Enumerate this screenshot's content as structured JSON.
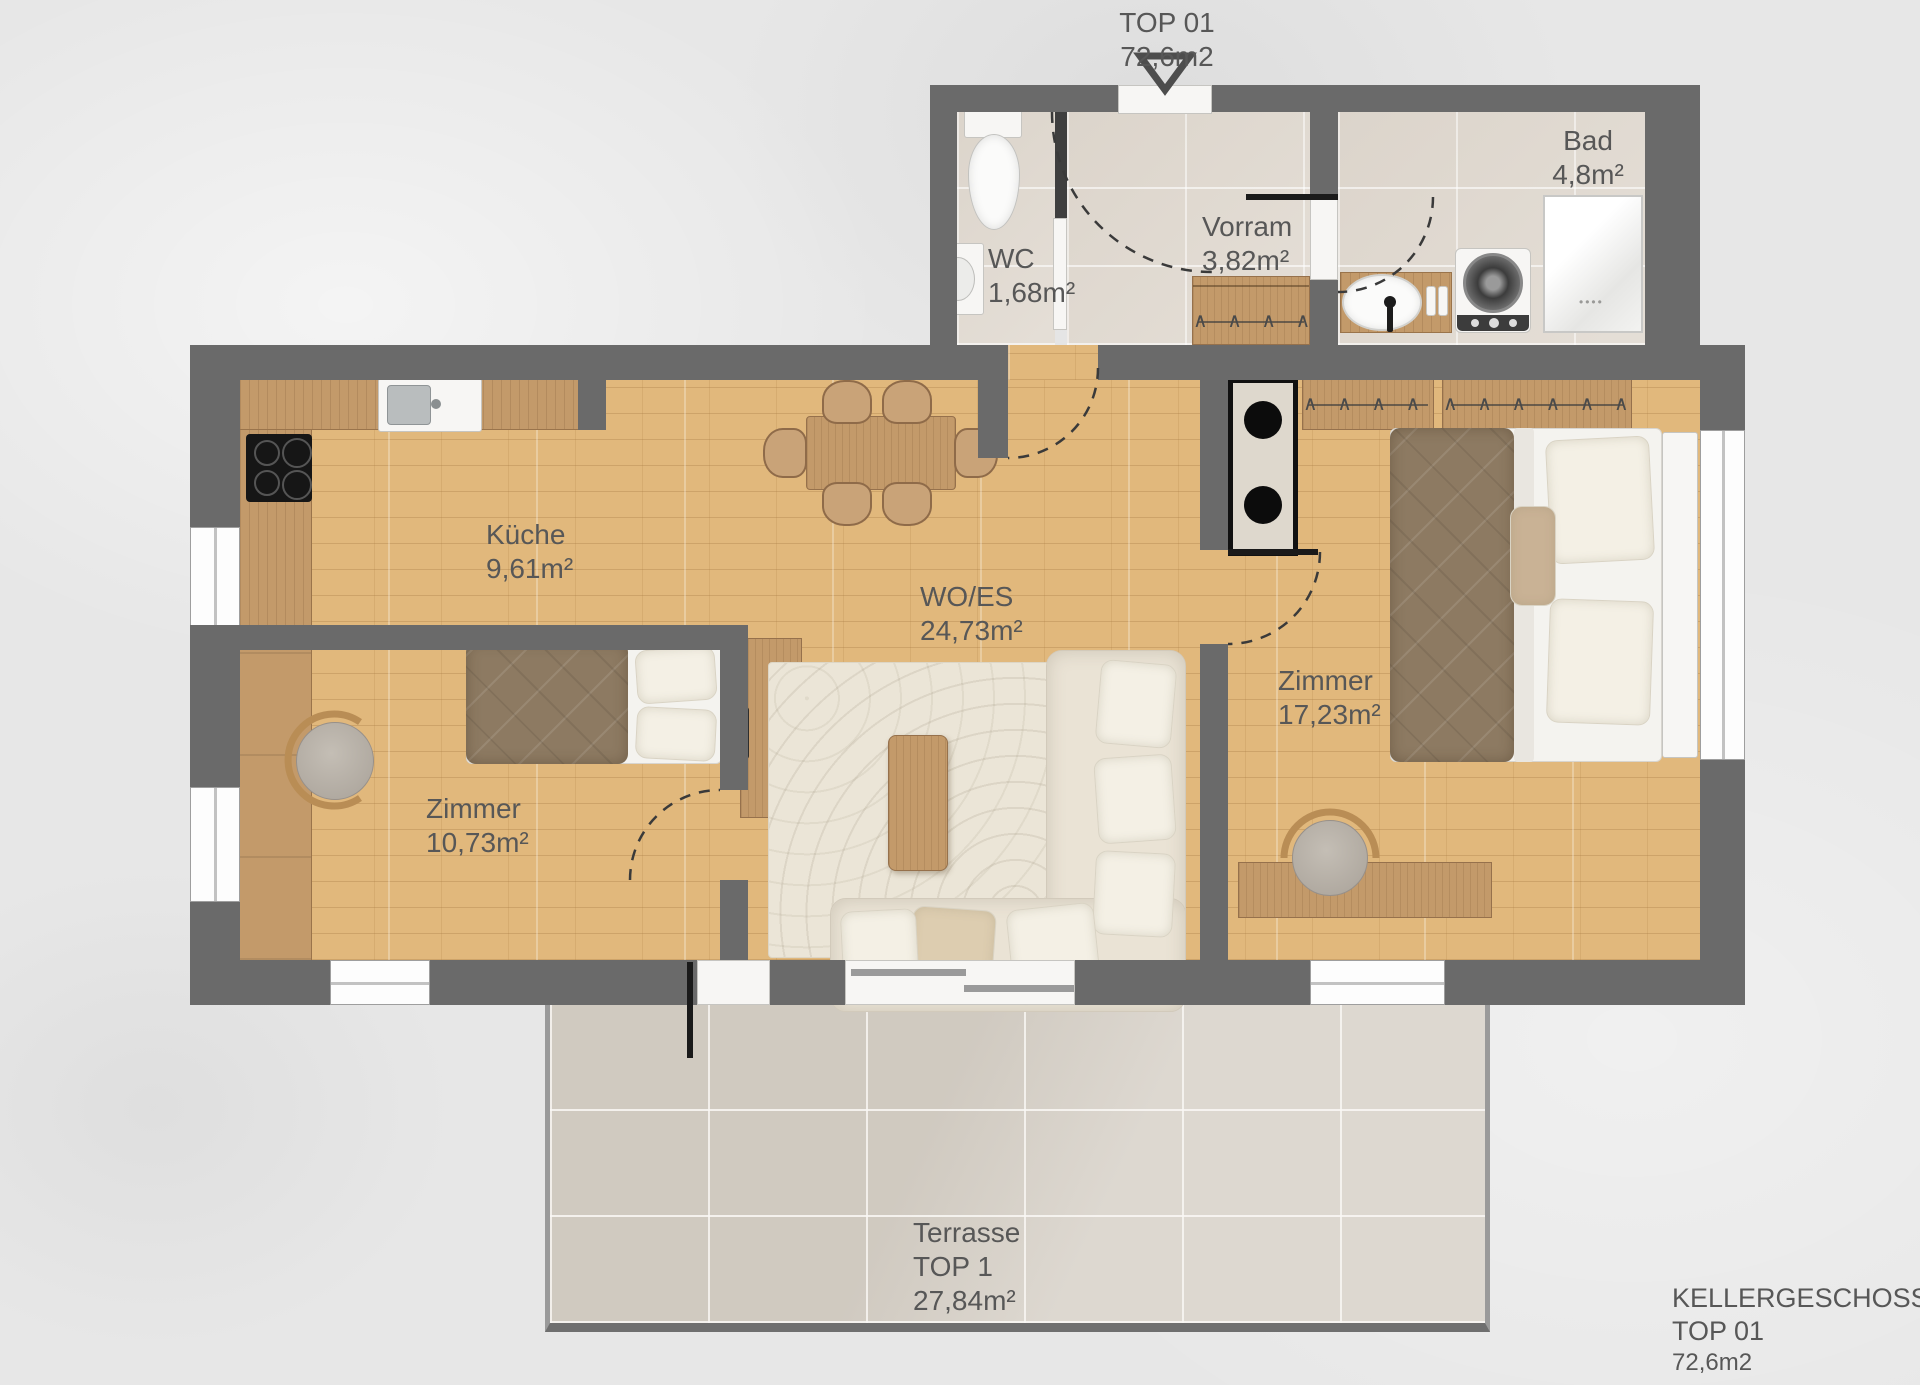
{
  "title_block": {
    "project": "TOP 01",
    "area": "72,6m2"
  },
  "footer": {
    "line1": "KELLERGESCHOSS",
    "line2": "TOP 01",
    "line3": "72,6m2"
  },
  "rooms": {
    "wc": {
      "name": "WC",
      "area": "1,68m²"
    },
    "vorraum": {
      "name": "Vorram",
      "area": "3,82m²"
    },
    "bad": {
      "name": "Bad",
      "area": "4,8m²"
    },
    "kueche": {
      "name": "Küche",
      "area": "9,61m²"
    },
    "wohnen_essen": {
      "name": "WO/ES",
      "area": "24,73m²"
    },
    "zimmer_gross": {
      "name": "Zimmer",
      "area": "17,23m²"
    },
    "zimmer_klein": {
      "name": "Zimmer",
      "area": "10,73m²"
    },
    "terrasse": {
      "name": "Terrasse",
      "unit": "TOP 1",
      "area": "27,84m²"
    }
  },
  "icons": {
    "hanger_row_small": "∧ ∧ ∧ ∧",
    "hanger_row_medium": "∧ ∧ ∧ ∧ ∧",
    "hanger_row_large": "∧ ∧ ∧ ∧ ∧ ∧ ∧"
  },
  "colors": {
    "wall": "#6a6a6a",
    "wood_floor": "#e1b87c",
    "furniture_wood": "#c39a6a",
    "tile_floor": "#e1dad1",
    "terrace_tile": "#d7d1c8",
    "label_text": "#575757",
    "fixture_white": "#f7f6f4",
    "textile_brown": "#8d7a62",
    "sofa_cream": "#ebe5d7"
  }
}
